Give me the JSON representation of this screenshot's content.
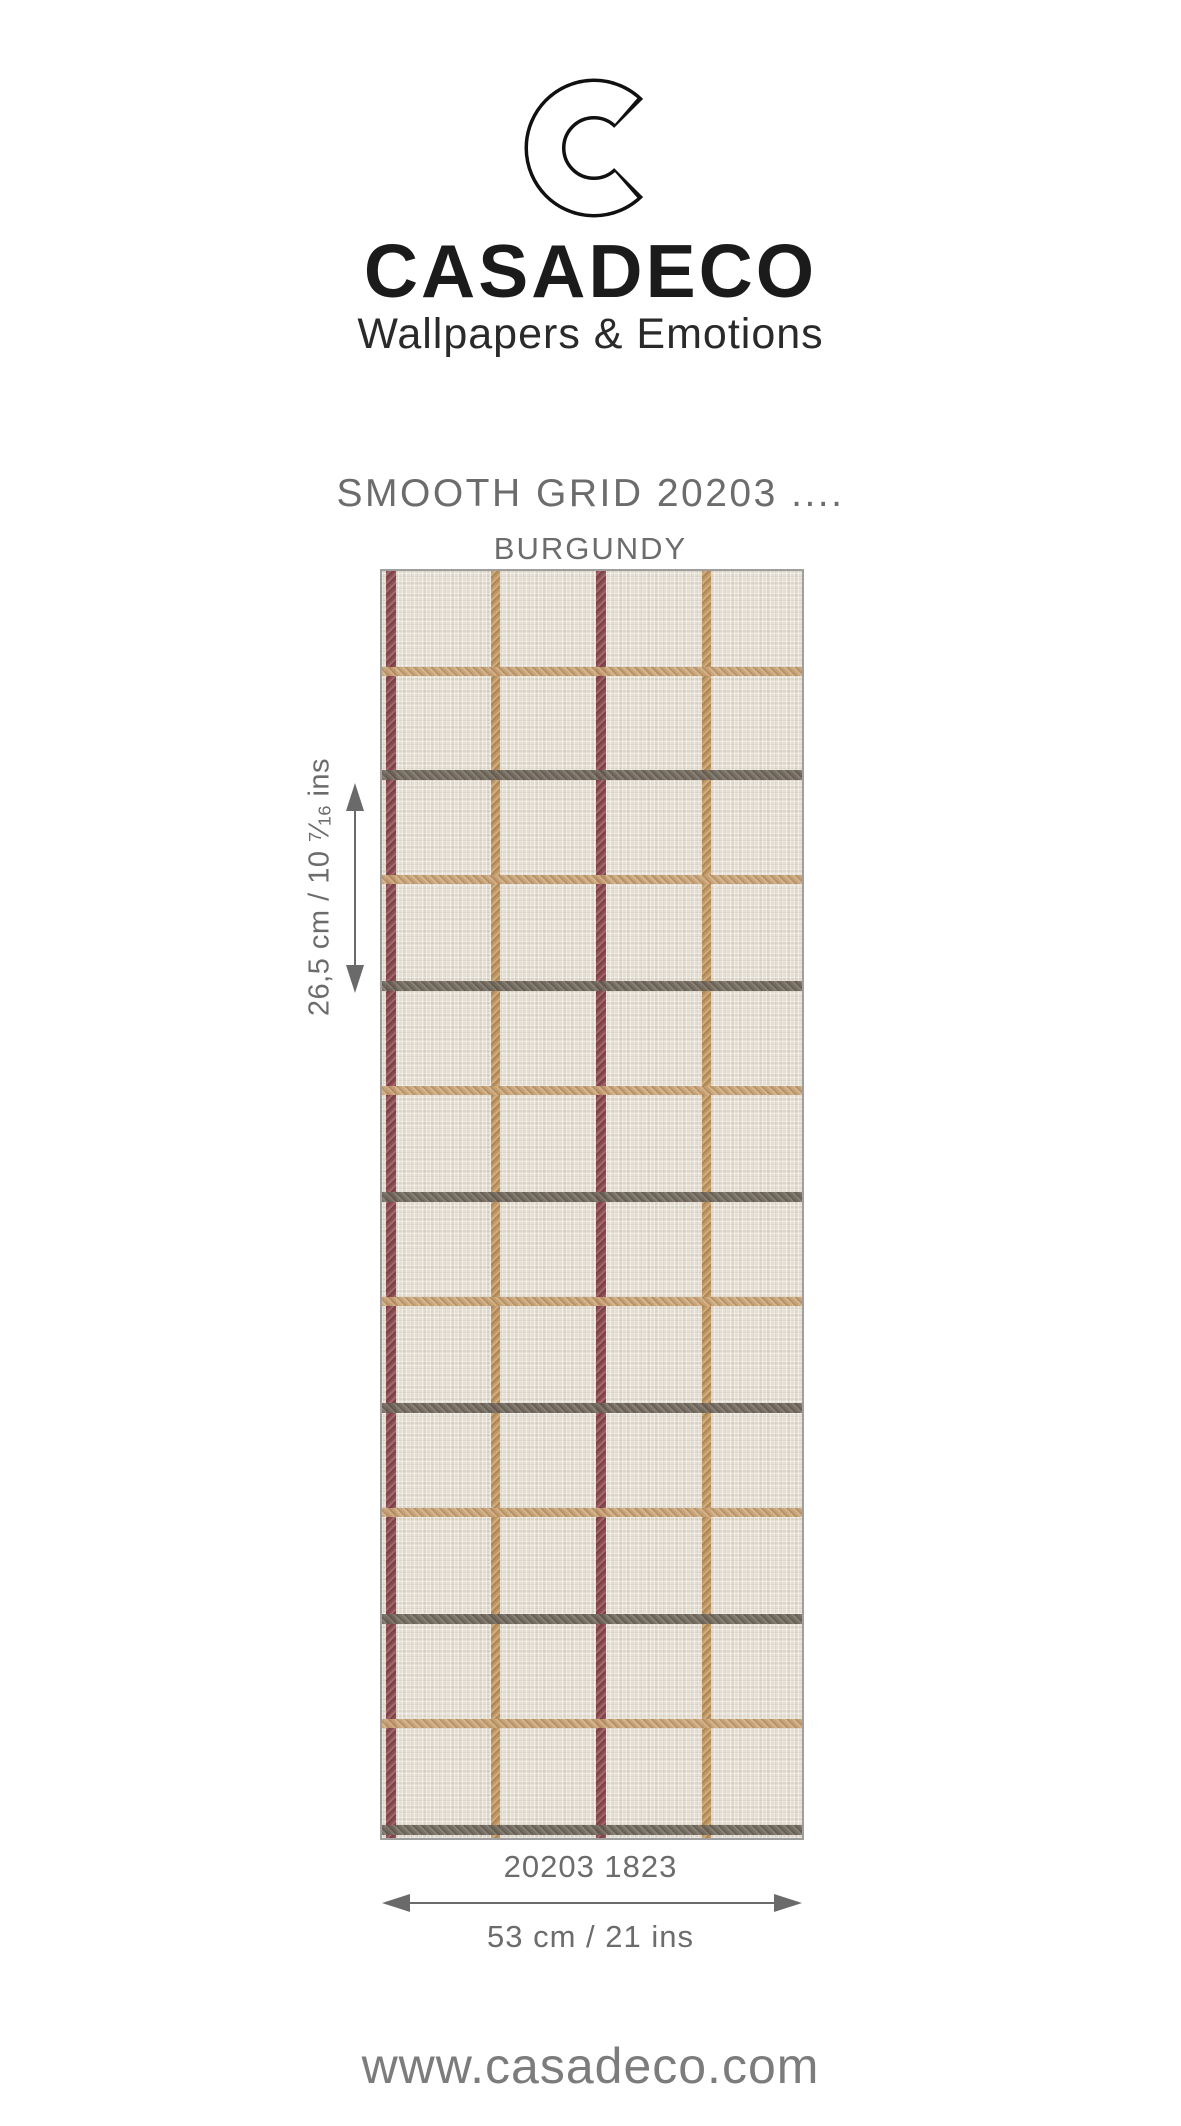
{
  "brand": {
    "name": "CASADECO",
    "tagline": "Wallpapers & Emotions"
  },
  "product": {
    "title": "SMOOTH GRID 20203 ....",
    "colorway": "BURGUNDY",
    "code": "20203 1823"
  },
  "dimensions": {
    "vertical_repeat": {
      "prefix": "26,5 cm / 10 ",
      "frac_num": "7",
      "frac_slash": "⁄",
      "frac_den": "16",
      "suffix": " ins"
    },
    "width": "53 cm / 21 ins"
  },
  "footer": {
    "website": "www.casadeco.com"
  },
  "colors": {
    "brand_ink": "#1b1b1b",
    "label_gray": "#6c6c6c",
    "arrow_gray": "#6a6a6a",
    "swatch_border": "#9f9f9f",
    "swatch_background": "#e5dfd1",
    "burgundy": "#8c4d52",
    "tan_vertical": "#bf9765",
    "tan_horizontal": "#c5a074",
    "gray_line": "#6e665b"
  },
  "swatch": {
    "stripe_thickness": 9,
    "vertical_stripes": [
      {
        "color": "burgundy",
        "x": 4,
        "w": 10
      },
      {
        "color": "tan_vertical",
        "x": 109,
        "w": 9
      },
      {
        "color": "burgundy",
        "x": 214,
        "w": 10
      },
      {
        "color": "tan_vertical",
        "x": 320,
        "w": 9
      }
    ],
    "horizontal_stripes": [
      {
        "color": "tan_horizontal",
        "y": 96,
        "h": 9
      },
      {
        "color": "gray",
        "y": 199,
        "h": 10
      },
      {
        "color": "tan_horizontal",
        "y": 304,
        "h": 9
      },
      {
        "color": "gray",
        "y": 410,
        "h": 10
      },
      {
        "color": "tan_horizontal",
        "y": 515,
        "h": 9
      },
      {
        "color": "gray",
        "y": 621,
        "h": 10
      },
      {
        "color": "tan_horizontal",
        "y": 726,
        "h": 9
      },
      {
        "color": "gray",
        "y": 832,
        "h": 10
      },
      {
        "color": "tan_horizontal",
        "y": 937,
        "h": 9
      },
      {
        "color": "gray",
        "y": 1043,
        "h": 10
      },
      {
        "color": "tan_horizontal",
        "y": 1148,
        "h": 9
      },
      {
        "color": "gray",
        "y": 1254,
        "h": 10
      }
    ]
  }
}
